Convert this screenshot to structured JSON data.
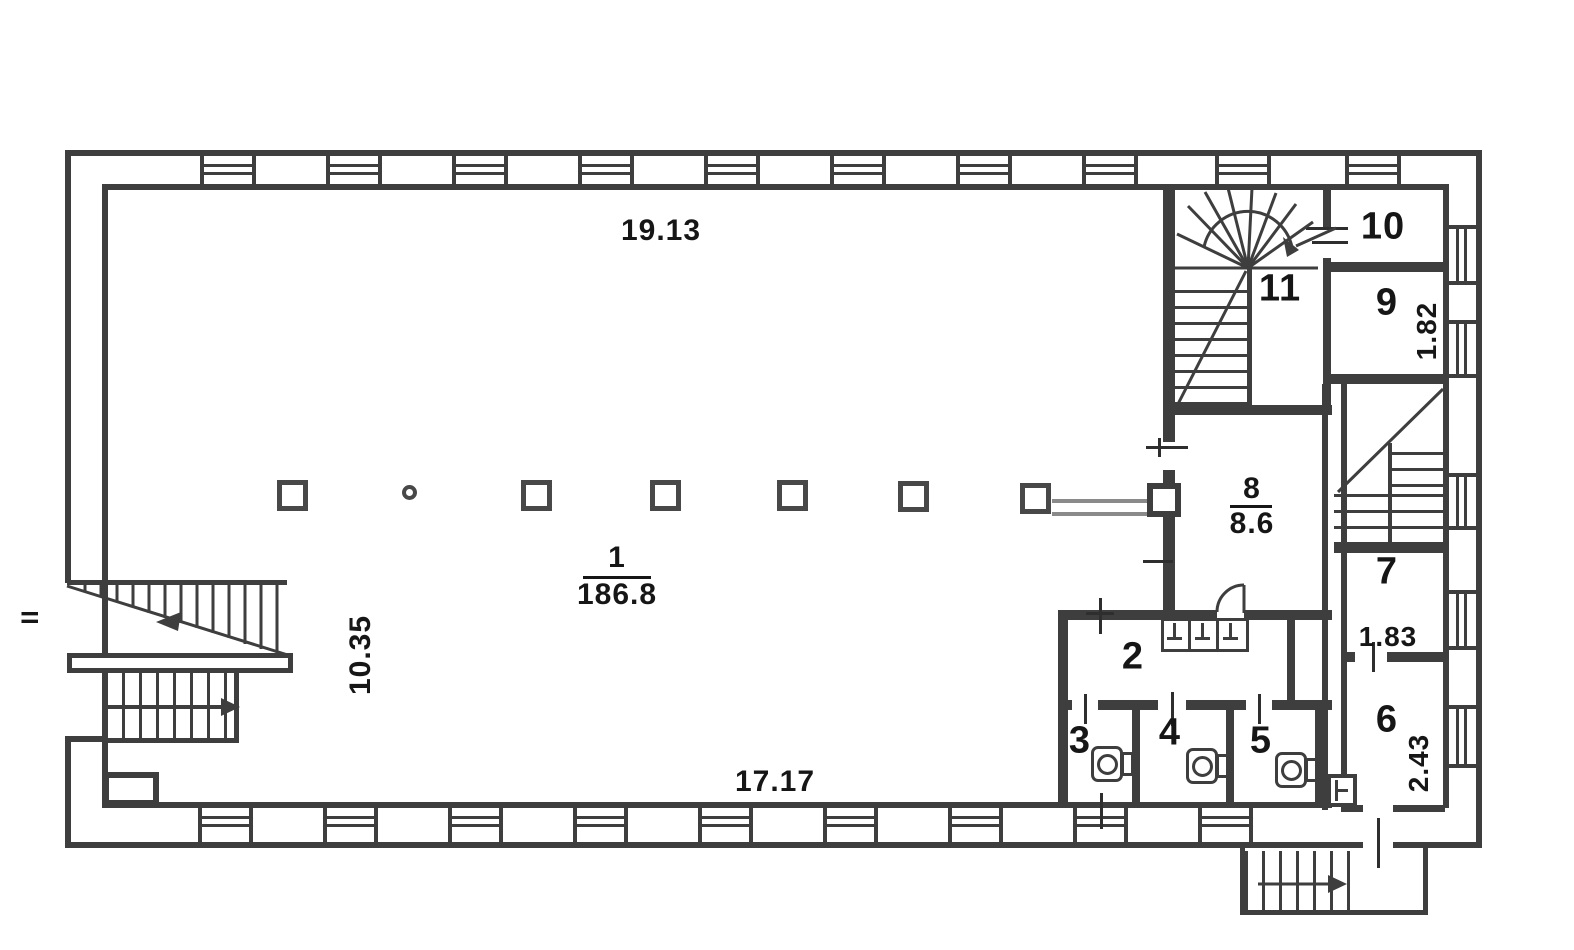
{
  "plan": {
    "dimensions": {
      "top_width": "19.13",
      "left_height": "10.35",
      "bottom_width": "17.17"
    },
    "entrance": "II",
    "rooms": [
      {
        "number": "1",
        "area": "186.8"
      },
      {
        "number": "2"
      },
      {
        "number": "3"
      },
      {
        "number": "4"
      },
      {
        "number": "5"
      },
      {
        "number": "6",
        "dim": "2.43"
      },
      {
        "number": "7",
        "dim": "1.83"
      },
      {
        "number": "8",
        "area": "8.6"
      },
      {
        "number": "9",
        "dim": "1.82"
      },
      {
        "number": "10"
      },
      {
        "number": "11"
      }
    ]
  }
}
